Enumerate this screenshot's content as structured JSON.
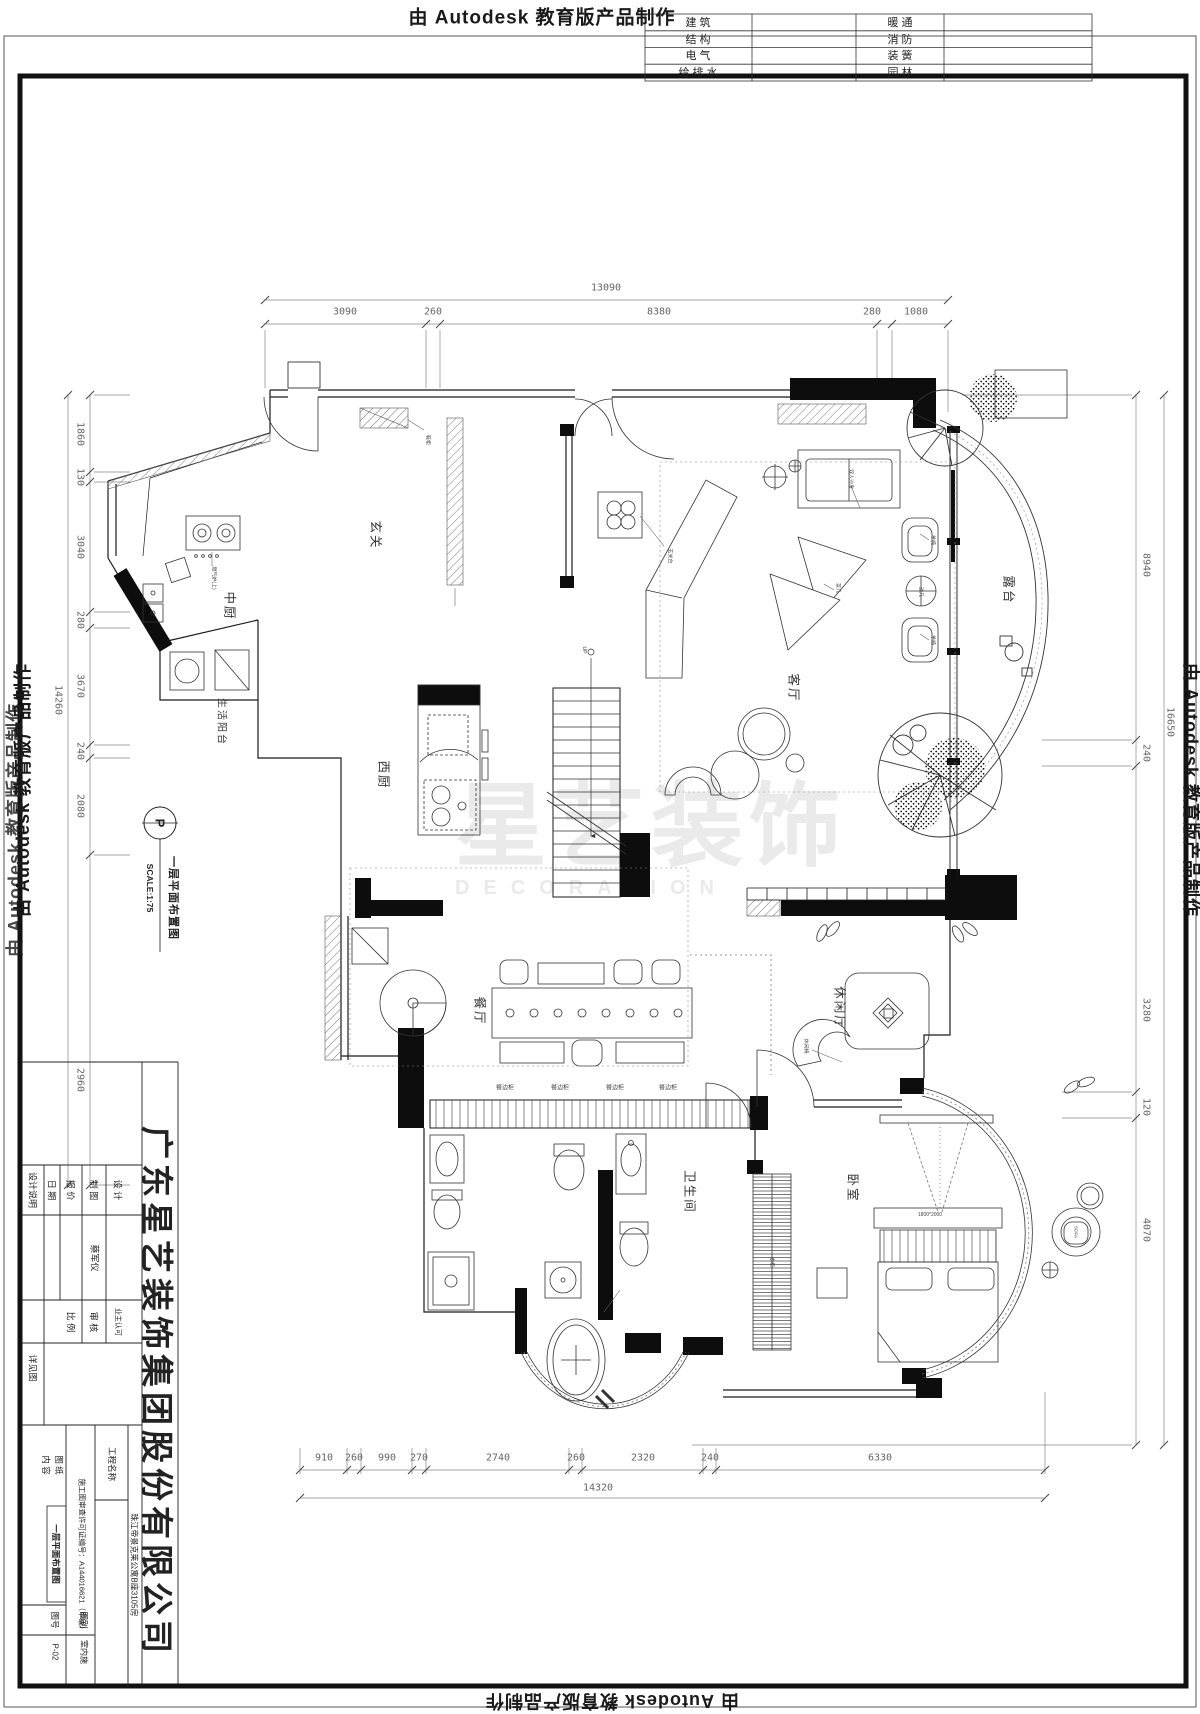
{
  "stamps": {
    "top": "由 Autodesk 教育版产品制作",
    "left": "由 Autodesk 教育版产品制作",
    "right": "由 Autodesk 教育版产品制作",
    "bottom": "由 Autodesk 教育版产品制作"
  },
  "discipline_table": {
    "left_labels": [
      "建  筑",
      "结  构",
      "电  气",
      "给 排 水"
    ],
    "right_labels": [
      "暖  通",
      "消  防",
      "装  簧",
      "园  林"
    ]
  },
  "plan_note": {
    "marker": "P",
    "title": "一层平面布置图",
    "scale": "SCALE:1:75"
  },
  "rooms": {
    "entry": "玄关",
    "chinese_kitchen": "中厨",
    "service_balcony": "生活阳台",
    "western_kitchen": "西厨",
    "living": "客厅",
    "terrace": "露台",
    "dining": "餐厅",
    "leisure": "休闲厅",
    "bathroom": "卫生间",
    "bedroom": "卧室"
  },
  "dims": {
    "top": {
      "total": "13090",
      "segments": [
        "3090",
        "260",
        "8380",
        "280",
        "1080"
      ]
    },
    "bottom": {
      "total": "14320",
      "segments": [
        "910",
        "260",
        "990",
        "270",
        "2740",
        "260",
        "2320",
        "240",
        "6330"
      ]
    },
    "left": {
      "total": "14260",
      "segments": [
        "1860",
        "130",
        "3040",
        "280",
        "3670",
        "240",
        "2080",
        "2960"
      ]
    },
    "right": {
      "total": "16650",
      "segments": [
        "8940",
        "240",
        "3280",
        "120",
        "4070"
      ]
    }
  },
  "annotations": {
    "shoe_cabinet": "鞋柜",
    "console": "玄关台",
    "stove": "燃气炉(上)",
    "double_sofa": "双人沙发",
    "chair": "单椅",
    "tea_table": "茶几",
    "side_table": "边几",
    "lounge_chair": "休闲椅",
    "sideboard": "餐边柜",
    "wardrobe": "衣柜",
    "sofa_tag": "SOFA",
    "bed_size": "1800*2000",
    "up": "UP"
  },
  "watermark": {
    "main": "星艺装饰",
    "sub": "DECORATION"
  },
  "title_block": {
    "note": "设计说明",
    "design_label": "设 计",
    "draft_label": "制 图",
    "quote_label": "报 价",
    "date_label": "日 期",
    "drafter": "蔡军仪",
    "owner_label": "业主认可",
    "review_label": "审 核",
    "scale_label": "比 例",
    "scale_value": "详见图",
    "project_label": "工程名称",
    "project_value": "珠江帝景克莱公寓B座3105房",
    "permit": "施工图审查许可证编号：A144016621（甲级）",
    "content_label_1": "图 纸",
    "content_label_2": "内 容",
    "content_value": "一层平面布置图",
    "category_label": "图别",
    "category_value": "室内施",
    "number_label": "图号",
    "number_value": "P-02",
    "company": "广东星艺装饰集团股份有限公司"
  }
}
